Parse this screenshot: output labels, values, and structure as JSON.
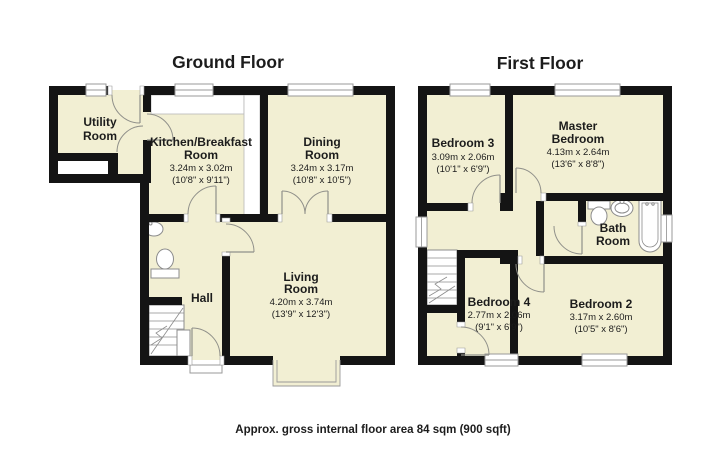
{
  "colors": {
    "room_fill": "#F2EFD3",
    "wall": "#141414",
    "window_line": "#9A9A9A",
    "door_line": "#90908A",
    "fixture_line": "#8C8C8C",
    "text": "#1C1C1C",
    "background": "#FFFFFF"
  },
  "icons": {
    "stairs-icon": "stepped treads with break line",
    "toilet-icon": "oval bowl with cistern",
    "basin-icon": "round basin with tap",
    "bathtub-icon": "rounded tub with taps",
    "window": "white bar with mullion line",
    "door-arc": "quarter-circle swing"
  },
  "ground_floor": {
    "title": "Ground Floor",
    "utility": {
      "line1": "Utility",
      "line2": "Room"
    },
    "kitchen": {
      "line1": "Kitchen/Breakfast",
      "line2": "Room",
      "metric": "3.24m x 3.02m",
      "imperial": "(10'8\" x 9'11\")"
    },
    "dining": {
      "line1": "Dining",
      "line2": "Room",
      "metric": "3.24m x 3.17m",
      "imperial": "(10'8\" x 10'5\")"
    },
    "hall": {
      "line1": "Hall"
    },
    "living": {
      "line1": "Living",
      "line2": "Room",
      "metric": "4.20m x 3.74m",
      "imperial": "(13'9\" x 12'3\")"
    }
  },
  "first_floor": {
    "title": "First Floor",
    "bedroom3": {
      "line1": "Bedroom 3",
      "metric": "3.09m x 2.06m",
      "imperial": "(10'1\" x 6'9\")"
    },
    "master": {
      "line1": "Master",
      "line2": "Bedroom",
      "metric": "4.13m x 2.64m",
      "imperial": "(13'6\" x 8'8\")"
    },
    "bathroom": {
      "line1": "Bath",
      "line2": "Room"
    },
    "bedroom4": {
      "line1": "Bedroom 4",
      "metric": "2.77m x 2.06m",
      "imperial": "(9'1\" x 6'9\")"
    },
    "bedroom2": {
      "line1": "Bedroom 2",
      "metric": "3.17m x 2.60m",
      "imperial": "(10'5\" x 8'6\")"
    }
  },
  "caption": "Approx. gross internal floor area 84 sqm (900 sqft)"
}
